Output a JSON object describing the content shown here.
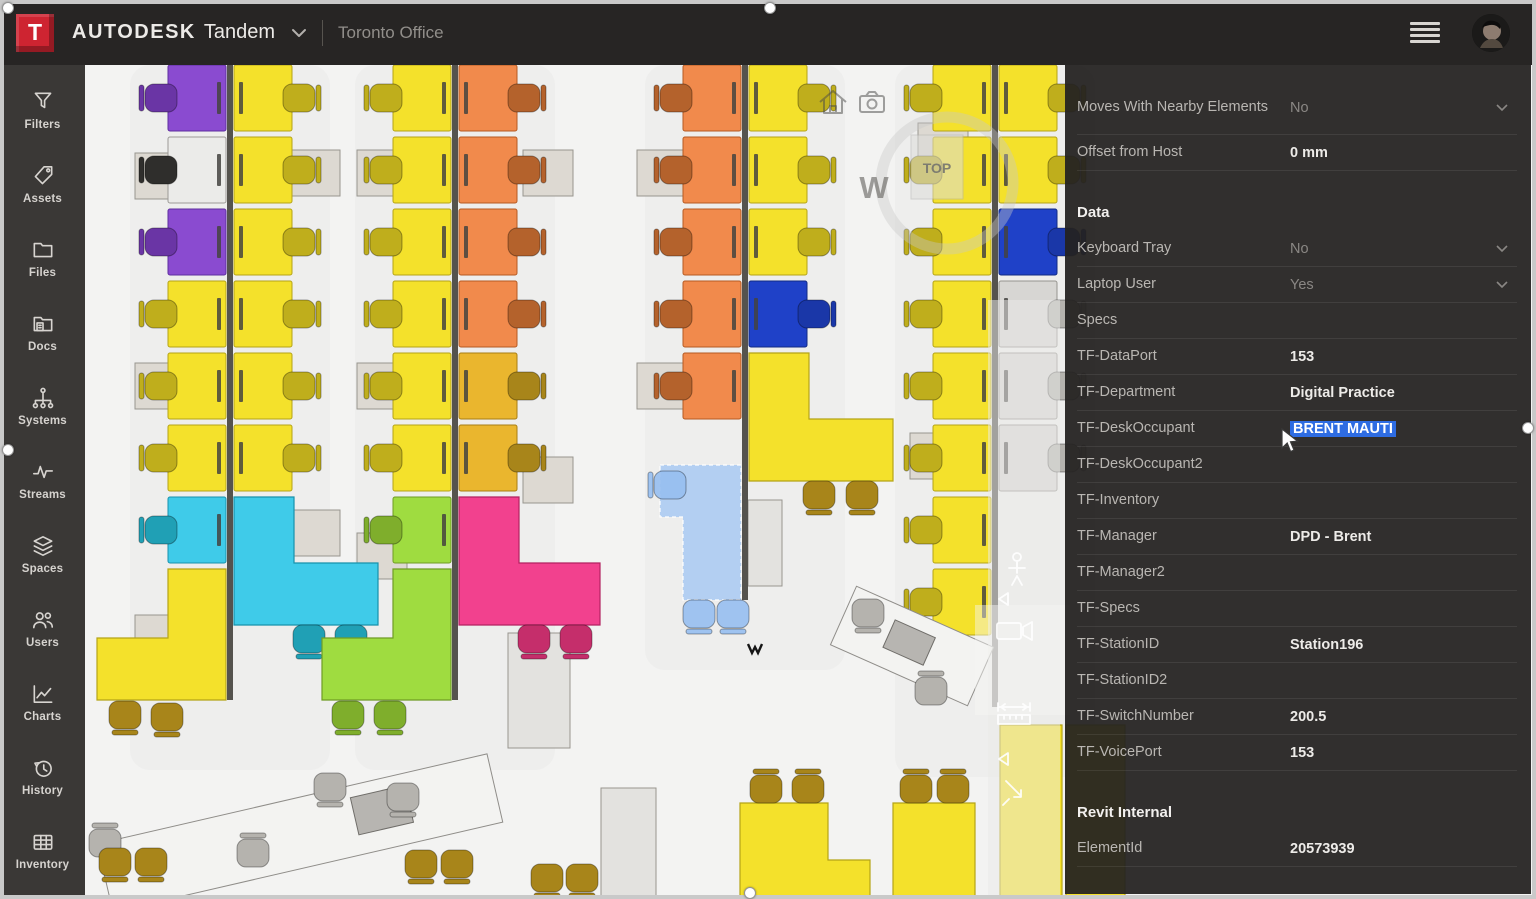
{
  "header": {
    "logo_letter": "T",
    "brand_bold": "AUTODESK",
    "brand_regular": "Tandem",
    "facility": "Toronto Office"
  },
  "sidebar": {
    "items": [
      {
        "label": "Filters",
        "icon": "funnel-icon"
      },
      {
        "label": "Assets",
        "icon": "tag-icon"
      },
      {
        "label": "Files",
        "icon": "folder-icon"
      },
      {
        "label": "Docs",
        "icon": "docs-icon"
      },
      {
        "label": "Systems",
        "icon": "systems-icon"
      },
      {
        "label": "Streams",
        "icon": "streams-icon"
      },
      {
        "label": "Spaces",
        "icon": "spaces-icon"
      },
      {
        "label": "Users",
        "icon": "users-icon"
      },
      {
        "label": "Charts",
        "icon": "charts-icon"
      },
      {
        "label": "History",
        "icon": "history-icon"
      },
      {
        "label": "Inventory",
        "icon": "inventory-icon"
      }
    ]
  },
  "viewer": {
    "compass_letter": "W",
    "viewcube_label": "TOP",
    "icons": [
      "home-icon",
      "camera-icon",
      "walk-icon",
      "video-camera-icon",
      "measure-icon",
      "rotate-arrow-icon"
    ]
  },
  "panel": {
    "properties": [
      {
        "label": "Moves With Nearby Elements",
        "value": "No",
        "muted": true,
        "dropdown": true,
        "tall": true
      },
      {
        "label": "Offset from Host",
        "value": "0 mm"
      },
      {
        "header": "Data"
      },
      {
        "label": "Keyboard Tray",
        "value": "No",
        "muted": true,
        "dropdown": true
      },
      {
        "label": "Laptop User",
        "value": "Yes",
        "muted": true,
        "dropdown": true
      },
      {
        "label": "Specs",
        "value": ""
      },
      {
        "label": "TF-DataPort",
        "value": "153"
      },
      {
        "label": "TF-Department",
        "value": "Digital Practice"
      },
      {
        "label": "TF-DeskOccupant",
        "value": "BRENT MAUTI",
        "selected": true
      },
      {
        "label": "TF-DeskOccupant2",
        "value": ""
      },
      {
        "label": "TF-Inventory",
        "value": ""
      },
      {
        "label": "TF-Manager",
        "value": "DPD - Brent"
      },
      {
        "label": "TF-Manager2",
        "value": ""
      },
      {
        "label": "TF-Specs",
        "value": ""
      },
      {
        "label": "TF-StationID",
        "value": "Station196"
      },
      {
        "label": "TF-StationID2",
        "value": ""
      },
      {
        "label": "TF-SwitchNumber",
        "value": "200.5"
      },
      {
        "label": "TF-VoicePort",
        "value": "153"
      },
      {
        "header": "Revit Internal"
      },
      {
        "label": "ElementId",
        "value": "20573939"
      }
    ]
  },
  "colors": {
    "brand_red": "#ce2431",
    "topbar_bg": "#272524",
    "sidebar_bg": "#3a3836",
    "panel_bg": "rgba(36,34,33,0.94)",
    "selection_blue": "#2e6ce2"
  },
  "floorplan": {
    "floor": "#f3f3f2",
    "palette": {
      "purple": {
        "f": "#8a4bd0",
        "s": "#5f2fa0",
        "c": "#6a35a5"
      },
      "yellow": {
        "f": "#f4e12b",
        "s": "#b5a417",
        "c": "#bfae1c"
      },
      "gold": {
        "f": "#eab62e",
        "s": "#a87e14",
        "c": "#a8851a"
      },
      "white": {
        "f": "#ebebe9",
        "s": "#9c9a97",
        "c": "#c6c4c0"
      },
      "orange": {
        "f": "#f18a4c",
        "s": "#b55a22",
        "c": "#b4622c"
      },
      "cyan": {
        "f": "#3fcbe9",
        "s": "#1792ad",
        "c": "#20a0b5"
      },
      "green": {
        "f": "#9fdc40",
        "s": "#6f9c24",
        "c": "#7fae2c"
      },
      "pink": {
        "f": "#f2418e",
        "s": "#b32261",
        "c": "#c52e6b"
      },
      "blue": {
        "f": "#1f41c8",
        "s": "#122a85",
        "c": "#1a37a8"
      },
      "gray": {
        "f": "#d7d6d3",
        "s": "#96948f",
        "c": "#b5b3ae"
      },
      "ghost": {
        "f": "rgba(163,198,244,0.78)",
        "s": "#ffffff",
        "c": "rgba(150,190,240,0.9)",
        "dash": 1
      }
    },
    "columns": [
      {
        "x": 145,
        "len": 635,
        "rows": [
          [
            "purple",
            "yellow"
          ],
          [
            "white",
            "yellow",
            "#2f2e2c"
          ],
          [
            "purple",
            "yellow"
          ],
          [
            "yellow",
            "yellow"
          ],
          [
            "yellow",
            "yellow"
          ],
          [
            "yellow",
            "yellow"
          ],
          [
            "cyan",
            null
          ]
        ]
      },
      {
        "x": 370,
        "len": 635,
        "rows": [
          [
            "yellow",
            "orange"
          ],
          [
            "yellow",
            "orange"
          ],
          [
            "yellow",
            "orange"
          ],
          [
            "yellow",
            "orange"
          ],
          [
            "yellow",
            "gold"
          ],
          [
            "yellow",
            "gold"
          ],
          [
            "green",
            null
          ]
        ]
      },
      {
        "x": 660,
        "len": 535,
        "rows": [
          [
            "orange",
            "yellow"
          ],
          [
            "orange",
            "yellow"
          ],
          [
            "orange",
            "yellow"
          ],
          [
            "orange",
            "blue"
          ],
          [
            "orange",
            null
          ]
        ]
      },
      {
        "x": 910,
        "len": 642,
        "rows": [
          [
            "yellow",
            "yellow"
          ],
          [
            "yellow",
            "yellow"
          ],
          [
            "yellow",
            "blue"
          ],
          [
            "yellow",
            "gray"
          ],
          [
            "yellow",
            "gray"
          ],
          [
            "yellow",
            "gray"
          ],
          [
            "yellow",
            null
          ],
          [
            "yellow",
            null
          ]
        ]
      }
    ],
    "cabinets": [
      [
        50,
        88
      ],
      [
        50,
        298
      ],
      [
        50,
        550
      ],
      [
        205,
        85
      ],
      [
        205,
        445
      ],
      [
        272,
        85
      ],
      [
        272,
        298
      ],
      [
        272,
        468
      ],
      [
        438,
        85
      ],
      [
        438,
        392
      ],
      [
        552,
        85
      ],
      [
        552,
        298
      ],
      [
        833,
        58
      ],
      [
        825,
        368
      ]
    ],
    "cabinets_big": [
      [
        423,
        568,
        62,
        115
      ],
      [
        663,
        435,
        34,
        86
      ],
      [
        516,
        723,
        55,
        111
      ]
    ],
    "lshapes": [
      {
        "pts": "149,432 209,432 209,498 293,498 293,560 149,560",
        "color": "cyan",
        "chairs": [
          [
            224,
            574,
            "cyan",
            "b"
          ],
          [
            266,
            574,
            "cyan",
            "b"
          ]
        ]
      },
      {
        "pts": "141,504 141,635 12,635 12,573 83,573 83,504",
        "color": "yellow",
        "chairs": [
          [
            40,
            650,
            "gold",
            "b"
          ],
          [
            82,
            652,
            "gold",
            "b"
          ]
        ]
      },
      {
        "pts": "374,432 434,432 434,498 515,498 515,560 374,560",
        "color": "pink",
        "chairs": [
          [
            449,
            574,
            "pink",
            "b"
          ],
          [
            491,
            574,
            "pink",
            "b"
          ]
        ]
      },
      {
        "pts": "366,504 366,635 237,635 237,573 308,573 308,504",
        "color": "green",
        "chairs": [
          [
            263,
            650,
            "green",
            "b"
          ],
          [
            305,
            650,
            "green",
            "b"
          ]
        ]
      },
      {
        "pts": "664,288 724,288 724,354 808,354 808,416 664,416",
        "color": "yellow",
        "chairs": [
          [
            734,
            430,
            "gold",
            "b"
          ],
          [
            777,
            430,
            "gold",
            "b"
          ]
        ]
      },
      {
        "pts": "575,400 656,400 656,535 598,535 598,452 575,452",
        "color": "ghost",
        "chairs": [
          [
            585,
            420,
            "ghost",
            "l"
          ],
          [
            614,
            549,
            "ghost",
            "b"
          ],
          [
            648,
            549,
            "ghost",
            "b"
          ]
        ]
      },
      {
        "pts": "655,738 743,738 743,795 785,795 785,834 655,834",
        "color": "yellow",
        "chairs": [
          [
            681,
            724,
            "gold",
            "t"
          ],
          [
            723,
            724,
            "gold",
            "t"
          ]
        ]
      },
      {
        "pts": "808,738 890,738 890,834 808,834",
        "color": "yellow",
        "chairs": [
          [
            831,
            724,
            "gold",
            "t"
          ],
          [
            868,
            724,
            "gold",
            "t"
          ]
        ]
      },
      {
        "pts": "915,660 977,660 977,834 915,834",
        "color": "yellow",
        "chairs": []
      },
      {
        "pts": "981,660 1040,660 1040,834 981,834",
        "color": "yellow",
        "chairs": []
      }
    ],
    "tables": [
      {
        "cx": 215,
        "cy": 768,
        "w": 400,
        "h": 70,
        "rot": -13,
        "box": [
          85,
          -4,
          56,
          38
        ]
      },
      {
        "cx": 827,
        "cy": 581,
        "w": 150,
        "h": 64,
        "rot": 24,
        "box": [
          -4,
          -2,
          44,
          30
        ]
      }
    ],
    "chairs_extra": [
      [
        245,
        722,
        "gray",
        "b"
      ],
      [
        318,
        732,
        "gray",
        "b"
      ],
      [
        168,
        788,
        "gray",
        "t"
      ],
      [
        20,
        778,
        "gray",
        "t"
      ],
      [
        -18,
        792,
        "gray",
        "t"
      ],
      [
        783,
        548,
        "gray",
        "b"
      ],
      [
        846,
        626,
        "gray",
        "t"
      ],
      [
        30,
        797,
        "gold",
        "b"
      ],
      [
        66,
        797,
        "gold",
        "b"
      ],
      [
        336,
        799,
        "gold",
        "b"
      ],
      [
        372,
        799,
        "gold",
        "b"
      ],
      [
        462,
        813,
        "gold",
        "b"
      ],
      [
        497,
        813,
        "gold",
        "b"
      ]
    ],
    "marker": [
      663,
      579
    ]
  }
}
